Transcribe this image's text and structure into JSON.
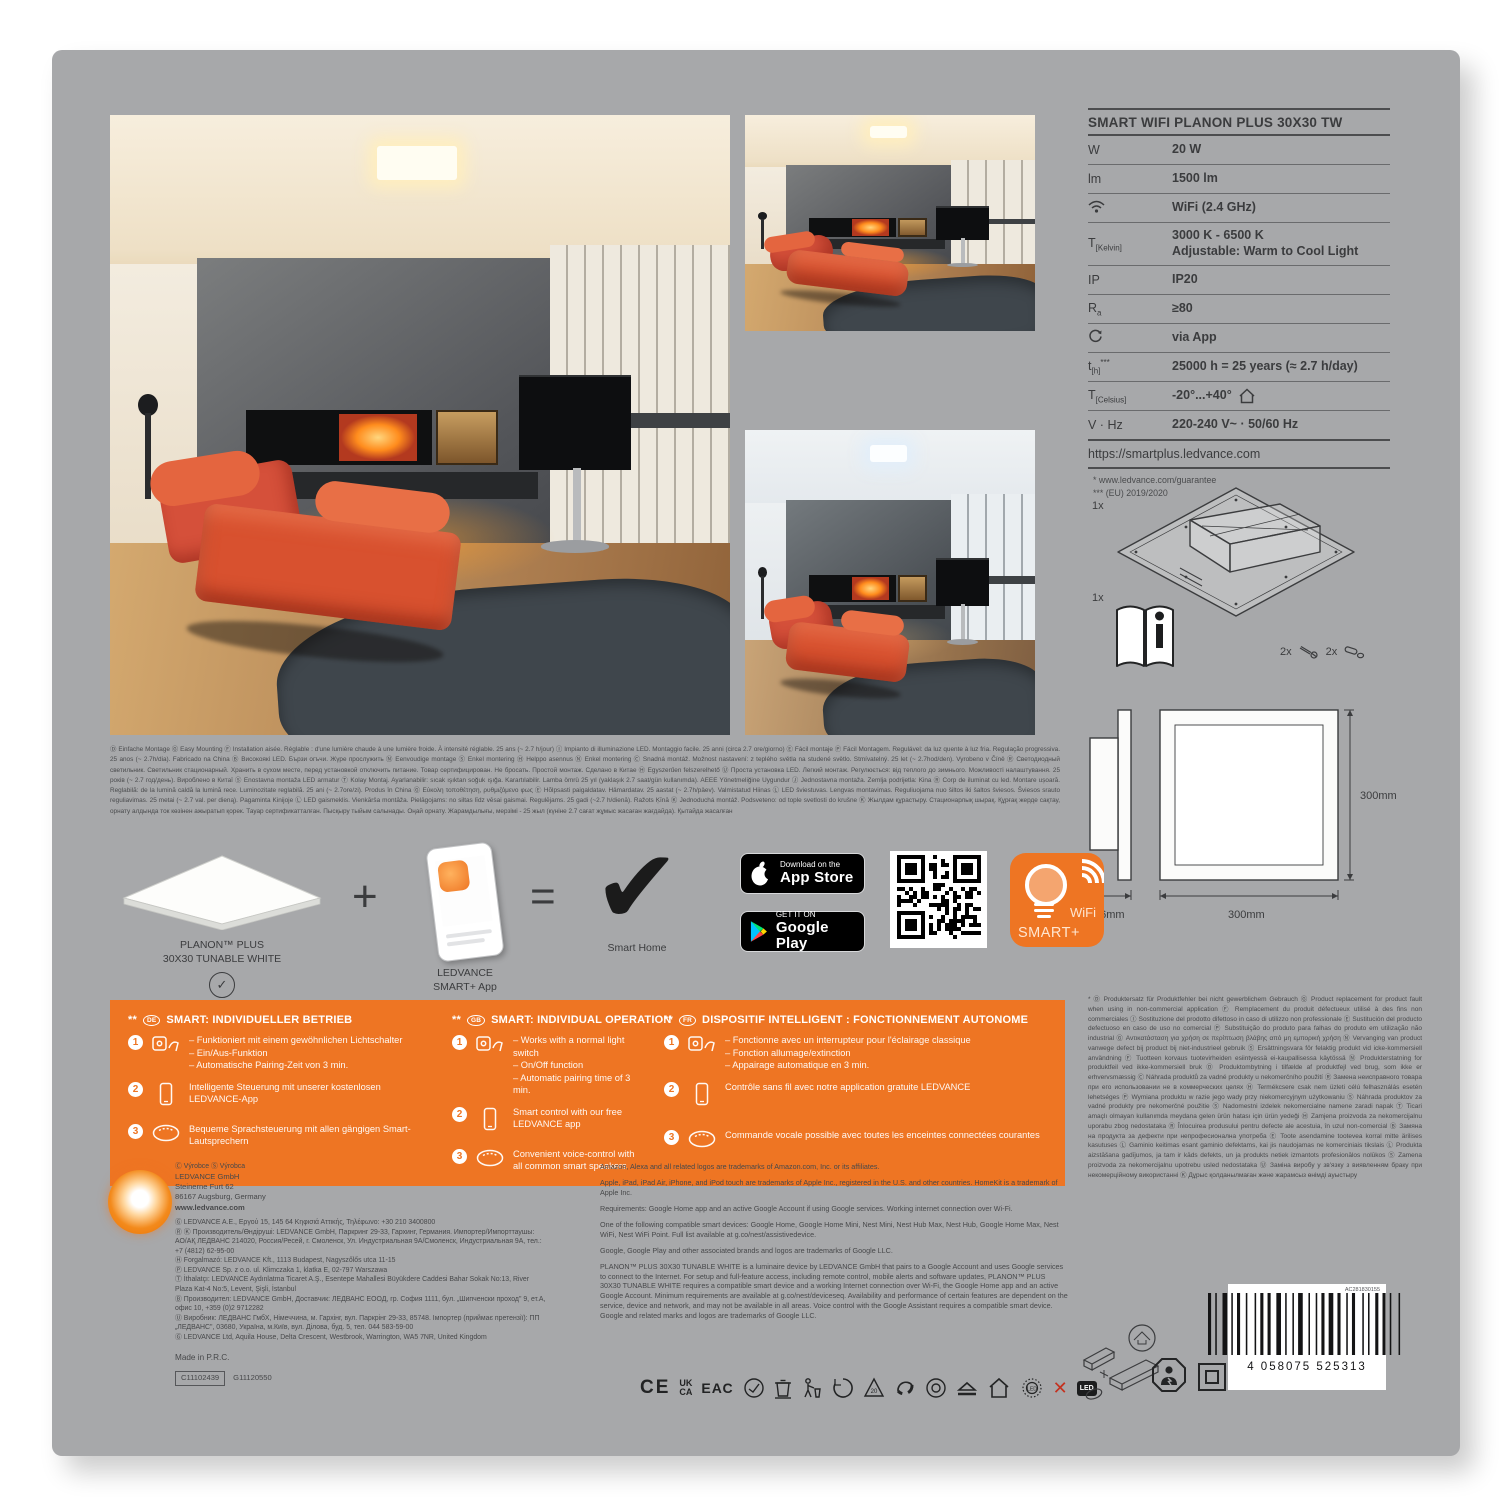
{
  "colors": {
    "accent_orange": "#ee7523",
    "card_gray": "#a7a8aa",
    "badge_black": "#000000"
  },
  "spec_table": {
    "title": "SMART WIFI PLANON PLUS 30X30 TW",
    "rows": [
      {
        "label": "W",
        "value": "20 W"
      },
      {
        "label": "lm",
        "value": "1500 lm"
      },
      {
        "value": "WiFi (2.4 GHz)"
      },
      {
        "label": "T",
        "label_sub": "[Kelvin]",
        "value": "3000 K - 6500 K",
        "value2": "Adjustable: Warm to Cool Light"
      },
      {
        "label": "IP",
        "value": "IP20"
      },
      {
        "label": "R",
        "label_sub": "a",
        "value": "≥80"
      },
      {
        "value": "via App"
      },
      {
        "label": "t",
        "label_sub": "[h]",
        "label_sup": "***",
        "value": "25000 h = 25 years (≈ 2.7 h/day)"
      },
      {
        "label": "T",
        "label_sub": "[Celsius]",
        "value": "-20°...+40°"
      },
      {
        "label": "V · Hz",
        "value": "220-240 V~ · 50/60 Hz"
      }
    ],
    "url": "https://smartplus.ledvance.com",
    "footnote1": "* www.ledvance.com/guarantee",
    "footnote2": "*** (EU) 2019/2020"
  },
  "package_contents": {
    "panel_qty": "1x",
    "manual_qty": "1x",
    "screws_qty": "2x",
    "plugs_qty": "2x"
  },
  "dimensions": {
    "depth": "56mm",
    "width": "300mm",
    "height": "300mm"
  },
  "mounting_text": "Ⓓ Einfache Montage Ⓖ Easy Mounting Ⓕ Installation aisée. Réglable : d'une lumière chaude à une lumière froide. À intensité réglable. 25 ans (~ 2.7 h/jour) Ⓘ Impianto di illuminazione LED. Montaggio facile. 25 anni (circa 2.7 ore/giorno) Ⓔ Fácil montaje Ⓟ Fácil Montagem. Regulável: da luz quente à luz fria. Regulação progressiva. 25 anos (~ 2.7h/dia). Fabricado na China Ⓑ Високоякі LED. Бързи огъчи. Жүре прослужить Ⓝ Eenvoudige montage Ⓢ Enkel montering Ⓗ Helppo asennus Ⓝ Enkel montering Ⓒ Snadná montáž. Možnost nastavení: z teplého světla na studené světlo. Stmívatelný. 25 let (~ 2.7hod/den). Vyrobeno v Číně Ⓡ Светодиодный светильник. Светильник стационарный. Хранить в сухом месте, перед установкой отключить питание. Товар сертифицирован. Не бросать. Простой монтаж. Сделано в Китае Ⓗ Egyszerűen felszerelhető Ⓤ Проста установка LED. Легкий монтаж. Регулюється: від теплого до зимнього. Можливості налаштування. 25 років (~ 2.7 год/день). Вироблено в Китаї Ⓢ Enostavna montaža LED armatur Ⓣ Kolay Montaj. Ayarlanabilir: sıcak ışıktan soğuk ışığa. Karartılabilir. Lamba ömrü 25 yıl (yaklaşık 2.7 saat/gün kullanımda). AEEE Yönetmeliğine Uygundur Ⓙ Jednostavna montaža. Zemlja podrijetla: Kina Ⓡ Corp de iluminat cu led. Montare ușoară. Reglabilă: de la lumină caldă la lumină rece. Luminozitate reglabilă. 25 ani (~ 2.7ore/zi). Produs în China Ⓖ Εύκολη τοποθέτηση, ρυθμιζόμενο φως Ⓔ Hõlpsasti paigaldatav. Hämardatav. 25 aastat (~ 2.7h/päev). Valmistatud Hiinas Ⓛ LED šviestuvas. Lengvas montavimas. Reguliuojama nuo šiltos iki šaltos šviesos. Šviesos srauto reguliavimas. 25 metai (~ 2.7 val. per dieną). Pagaminta Kinijoje Ⓛ LED gaismeklis. Vienkārša montāža. Pielāgojams: no siltas līdz vēsai gaismai. Regulējams. 25 gadi (~2.7 h/dienā). Ražots Ķīnā Ⓚ Jednoduchá montáž. Podsveteno: od tople svetlosti do krušne Ⓚ Жылдам құрастыру. Стационарлық шырақ. Құрғақ жерде сақтау, орнату алдында ток көзінен ажыратып қорек. Тауар сертификатталған. Пысқыру тыйым салынады. Оңай орнату. Жарамдылығы, мерзімі - 25 жыл (күніне 2.7 сағат жұмыс жасаған жағдайда). Қытайда жасалған",
  "smart_row": {
    "panel_label_1": "PLANON™ PLUS",
    "panel_label_2": "30X30 TUNABLE WHITE",
    "plus": "+",
    "app_label_1": "LEDVANCE",
    "app_label_2": "SMART+ App",
    "equals": "=",
    "result_label": "Smart Home",
    "check_glyph": "✓",
    "big_check_glyph": "✔"
  },
  "badges": {
    "app_store_small": "Download on the",
    "app_store_big": "App Store",
    "google_play_small": "GET IT ON",
    "google_play_big": "Google Play"
  },
  "smartplus_logo": {
    "line1": "WiFi",
    "line2": "SMART+"
  },
  "smart_features": {
    "columns": [
      {
        "marker": "**",
        "lang": "DE",
        "title": "SMART: INDIVIDUELLER BETRIEB",
        "items": [
          {
            "lines": [
              "– Funktioniert mit einem gewöhnlichen Lichtschalter",
              "– Ein/Aus-Funktion",
              "– Automatische Pairing-Zeit von 3 min."
            ]
          },
          {
            "text": "Intelligente Steuerung mit unserer kostenlosen LEDVANCE-App"
          },
          {
            "text": "Bequeme Sprachsteuerung mit allen gängigen Smart-Lautsprechern"
          }
        ],
        "nums": [
          "1",
          "2",
          "3"
        ]
      },
      {
        "marker": "**",
        "lang": "GB",
        "title": "SMART: INDIVIDUAL OPERATION",
        "items": [
          {
            "lines": [
              "– Works with a normal light switch",
              "– On/Off function",
              "– Automatic pairing time of 3 min."
            ]
          },
          {
            "text": "Smart control with our free LEDVANCE app"
          },
          {
            "text": "Convenient voice-control with all common smart speakers"
          }
        ],
        "nums": [
          "1",
          "2",
          "3"
        ]
      },
      {
        "marker": "**",
        "lang": "FR",
        "title": "DISPOSITIF INTELLIGENT : FONCTIONNEMENT AUTONOME",
        "items": [
          {
            "lines": [
              "– Fonctionne avec un interrupteur pour l'éclairage classique",
              "– Fonction allumage/extinction",
              "– Appairage automatique en 3 min."
            ]
          },
          {
            "text": "Contrôle sans fil avec notre application gratuite LEDVANCE"
          },
          {
            "text": "Commande vocale possible avec toutes les enceintes connectées courantes"
          }
        ],
        "nums": [
          "1",
          "2",
          "3"
        ]
      }
    ]
  },
  "address": {
    "lines": [
      "Ⓒ Výrobce    Ⓢ Výrobca",
      "LEDVANCE GmbH",
      "Steinerne Furt 62",
      "86167 Augsburg, Germany",
      "www.ledvance.com",
      "Ⓖ LEDVANCE A.E., Εργού 15, 145 64 Κηφισιά Αττικής, Τηλέφωνο: +30 210 3400800",
      "Ⓡ Ⓚ Производитель/Өндіруші: LEDVANCE GmbH, Паркринг 29-33, Гархинг, Германия. Импортер/Импорттаушы: АО/АҚ ЛЕДВАНС 214020, Россия/Ресей, г. Смоленск, Ул. Индустриальная 9А/Смоленск, Индустриальная 9А, тел.: +7 (4812) 62-95-00",
      "Ⓗ Forgalmazó: LEDVANCE Kft., 1113 Budapest, Nagyszőlős utca 11-15",
      "Ⓟ LEDVANCE Sp. z o.o. ul. Klimczaka 1, klatka E, 02-797 Warszawa",
      "Ⓣ İthalatçı: LEDVANCE Aydınlatma Ticaret A.Ş., Esentepe Mahallesi Büyükdere Caddesi Bahar Sokak No:13, River Plaza Kat-4 No:5, Levent, Şişli, İstanbul",
      "Ⓑ Производител: LEDVANCE GmbH, Доставчик: ЛЕДВАНС ЕООД, гр. София 1111, бул. „Шипченски проход\" 9, ет.А, офис 10, +359 (0)2 9712282",
      "Ⓤ Виробник: ЛЕДВАНС ГмбХ, Німеччина, м. Гархінг, вул. Паркрінг 29-33, 85748. Імпортер (приймає претензії): ПП „ЛЕДВАНС\", 03680, Україна, м.Київ, вул. Ділова, буд. 5, тел. 044 583-59-00",
      "Ⓖ LEDVANCE Ltd, Aquila House, Delta Crescent, Westbrook, Warrington, WA5 7NR, United Kingdom"
    ],
    "made_in": "Made in P.R.C.",
    "code_boxed": "C11102439",
    "code_plain": "G11120550"
  },
  "trademark_text": {
    "paragraphs": [
      "Amazon, Alexa and all related logos are trademarks of Amazon.com, Inc. or its affiliates.",
      "Apple, iPad, iPad Air, iPhone, and iPod touch are trademarks of Apple Inc., registered in the U.S. and other countries. HomeKit is a trademark of Apple Inc.",
      "Requirements: Google Home app and an active Google Account if using Google services. Working internet connection over Wi-Fi.",
      "One of the following compatible smart devices: Google Home, Google Home Mini, Nest Mini, Nest Hub Max, Nest Hub, Google Home Max, Nest WiFi, Nest WiFi Point. Full list available at g.co/nest/assistivedevice.",
      "Google, Google Play and other associated brands and logos are trademarks of Google LLC.",
      "PLANON™ PLUS 30X30 TUNABLE WHITE is a luminaire device by LEDVANCE GmbH that pairs to a Google Account and uses Google services to connect to the Internet. For setup and full-feature access, including remote control, mobile alerts and software updates, PLANON™ PLUS 30X30 TUNABLE WHITE requires a compatible smart device and a working Internet connection over Wi-Fi, the Google Home app and an active Google Account. Minimum requirements are available at g.co/nest/deviceseq. Availability and performance of certain features are dependent on the service, device and network, and may not be available in all areas. Voice control with the Google Assistant requires a compatible smart device. Google and related marks and logos are trademarks of Google LLC."
    ]
  },
  "guarantee_text": "* Ⓓ Produktersatz für Produktfehler bei nicht gewerblichem Gebrauch Ⓖ Product replacement for product fault when using in non-commercial application Ⓕ Remplacement du produit défectueux utilisé à des fins non commerciales Ⓘ Sostituzione del prodotto difettoso in caso di utilizzo non professionale Ⓔ Sustitución del producto defectuoso en caso de uso no comercial Ⓟ Substituição do produto para falhas do produto em utilização não industrial Ⓖ Αντικατάσταση για χρήση σε περίπτωση βλάβης από μη εμπορική χρήση Ⓝ Vervanging van product vanwege defect bij product bij niet-industrieel gebruik Ⓢ Ersättningsvara för felaktig produkt vid icke-kommersiell användning Ⓕ Tuotteen korvaus tuotevirheiden esiintyessä ei-kaupallisessa käytössä Ⓝ Produkterstatning for produktfeil ved ikke-kommersiell bruk Ⓓ Produktombytning i tilfælde af produktfejl ved brug, som ikke er erhvervsmæssig Ⓒ Náhrada produktů za vadné produkty u nekomerčního použití Ⓡ Замена неисправного товара при его использовании не в коммерческих целях Ⓗ Termékcsere csak nem üzleti célú felhasználás esetén lehetséges Ⓟ Wymiana produktu w razie jego wady przy niekomercyjnym użytkowaniu Ⓢ Náhrada produktov za vadné produkty pre nekomerčné použitie Ⓢ Nadomestni izdelek nekomercialne namene zaradi napak Ⓣ Ticari amaçlı olmayan kullanımda meydana gelen ürün hatası için ürün yedeği Ⓗ Zamjena proizvoda za nekomercijalnu uporabu zbog nedostataka Ⓡ Înlocuirea produsului pentru defecte ale acestuia, în uzul non-comercial Ⓑ Замяна на продукта за дефекти при непрофесионална употреба Ⓔ Toote asendamine tootevea korral mitte ärilises kasutuses Ⓛ Gaminio keitimas esant gaminio defektams, kai jis naudojamas ne komerciniais tikslais Ⓛ Produkta aizstāšana gadījumos, ja tam ir kāds defekts, un ja produkts netiek izmantots profesionālos nolūkos Ⓢ Zamena proizvoda za nekomercijalnu upotrebu usled nedostataka Ⓤ Заміна виробу у зв'язку з виявленням браку при некомерційному використанні Ⓚ Дұрыс қолданылмаған және жарамсыз өнімді ауыстыру",
  "cert_marks": {
    "ce": "CE",
    "uk": "UK",
    "ca": "CA",
    "eac": "ЕАС",
    "led_small": "LED",
    "led_box": "LED",
    "red_x": "✕"
  },
  "barcode": {
    "number": "4 058075 525313",
    "top_code": "AC281830155"
  }
}
